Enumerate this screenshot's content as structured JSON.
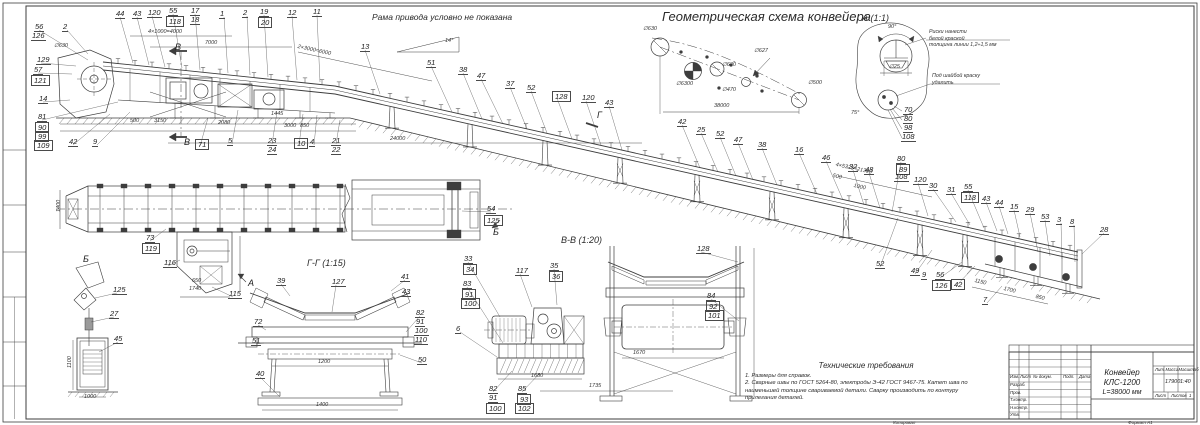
{
  "labels": {
    "frame_note": "Рама привода условно не показана",
    "scheme_title": "Геометрическая схема конвейера",
    "detail_a_title": "А (1:1)",
    "section_vv_title": "В-В (1:20)",
    "section_gg_title": "Г-Г (1:15)"
  },
  "detail_a": {
    "note1": "Риски нанести\nбелой краской\nтолщина линии 1,2÷1,5 мм",
    "note2": "Под шайбой краску\nудалить"
  },
  "tech": {
    "title": "Технические требования",
    "l1": "1. Размеры для справок.",
    "l2": "2. Сварные швы по ГОСТ 5264-80, электроды Э-42 ГОСТ 9467-75. Катет шва по",
    "l3": "наименьшей толщине свариваемой детали. Сварку производить по контуру",
    "l4": "прилегания деталей."
  },
  "title_block": {
    "name1": "Конвейер КЛС-1200",
    "name2": "L=38000 мм",
    "mass": "17900",
    "scale": "1:40",
    "h_lit": "Лит.",
    "h_mass": "Масса",
    "h_scale": "Масштаб",
    "h_sheet": "Лист",
    "h_sheets": "Листов",
    "sheets_val": "1",
    "c1": "Изм.",
    "c2": "Лист",
    "c3": "№ докум.",
    "c4": "Подп.",
    "c5": "Дата",
    "r1": "Разраб.",
    "r2": "Пров.",
    "r3": "Т.контр.",
    "r4": "Н.контр.",
    "r5": "Утв.",
    "footer_copy": "Копировал",
    "footer_format": "Формат А1"
  },
  "scheme_labels": [
    {
      "t": "∅630",
      "x": 643,
      "y": 27
    },
    {
      "t": "∅6300",
      "x": 676,
      "y": 82
    },
    {
      "t": "∅630",
      "x": 722,
      "y": 63
    },
    {
      "t": "∅627",
      "x": 754,
      "y": 49
    },
    {
      "t": "∅470",
      "x": 722,
      "y": 88
    },
    {
      "t": "∅500",
      "x": 808,
      "y": 81
    },
    {
      "t": "38000",
      "x": 714,
      "y": 104
    }
  ],
  "dims": [
    {
      "t": "500",
      "x": 130,
      "y": 119
    },
    {
      "t": "3150",
      "x": 154,
      "y": 119
    },
    {
      "t": "2080",
      "x": 218,
      "y": 121
    },
    {
      "t": "1445",
      "x": 271,
      "y": 112
    },
    {
      "t": "3000",
      "x": 284,
      "y": 124
    },
    {
      "t": "850",
      "x": 300,
      "y": 124
    },
    {
      "t": "4×1000=4000",
      "x": 148,
      "y": 30
    },
    {
      "t": "7000",
      "x": 205,
      "y": 41
    },
    {
      "t": "2×3000=6000",
      "x": 298,
      "y": 45,
      "r": 12
    },
    {
      "t": "24000",
      "x": 390,
      "y": 137
    },
    {
      "t": "14°",
      "x": 445,
      "y": 39
    },
    {
      "t": "∅630",
      "x": 54,
      "y": 44
    },
    {
      "t": "4×5325=21300",
      "x": 836,
      "y": 163,
      "r": 12
    },
    {
      "t": "500",
      "x": 833,
      "y": 174,
      "r": 12
    },
    {
      "t": "1000",
      "x": 854,
      "y": 184,
      "r": 12
    },
    {
      "t": "1150",
      "x": 975,
      "y": 279,
      "r": 13
    },
    {
      "t": "1700",
      "x": 1004,
      "y": 287,
      "r": 13
    },
    {
      "t": "850",
      "x": 1036,
      "y": 295,
      "r": 13
    },
    {
      "t": "650",
      "x": 192,
      "y": 279
    },
    {
      "t": "1740",
      "x": 189,
      "y": 287
    },
    {
      "t": "1400",
      "x": 57,
      "y": 212,
      "r": -90
    },
    {
      "t": "1100",
      "x": 68,
      "y": 368,
      "r": -90
    },
    {
      "t": "1000",
      "x": 84,
      "y": 395
    },
    {
      "t": "1200",
      "x": 318,
      "y": 360
    },
    {
      "t": "1400",
      "x": 316,
      "y": 403
    },
    {
      "t": "1680",
      "x": 531,
      "y": 374
    },
    {
      "t": "1735",
      "x": 589,
      "y": 384
    },
    {
      "t": "1670",
      "x": 633,
      "y": 351
    },
    {
      "t": "∅25",
      "x": 889,
      "y": 65
    },
    {
      "t": "90°",
      "x": 888,
      "y": 25
    },
    {
      "t": "75°",
      "x": 851,
      "y": 111
    }
  ],
  "callouts": [
    {
      "t": "56",
      "x": 34,
      "y": 23,
      "tx": 88,
      "ty": 60
    },
    {
      "t": "126",
      "x": 31,
      "y": 32
    },
    {
      "t": "129",
      "x": 36,
      "y": 56,
      "tx": 76,
      "ty": 66
    },
    {
      "t": "57",
      "x": 33,
      "y": 66,
      "tx": 72,
      "ty": 74
    },
    {
      "t": "121",
      "x": 31,
      "y": 75,
      "b": 1
    },
    {
      "t": "14",
      "x": 38,
      "y": 95,
      "tx": 70,
      "ty": 100
    },
    {
      "t": "81",
      "x": 37,
      "y": 113,
      "tx": 118,
      "ty": 102
    },
    {
      "t": "90",
      "x": 35,
      "y": 122,
      "b": 1
    },
    {
      "t": "99",
      "x": 35,
      "y": 131,
      "b": 1
    },
    {
      "t": "109",
      "x": 34,
      "y": 140,
      "b": 1
    },
    {
      "t": "42",
      "x": 68,
      "y": 138,
      "tx": 110,
      "ty": 114
    },
    {
      "t": "9",
      "x": 92,
      "y": 138,
      "tx": 130,
      "ty": 112
    },
    {
      "t": "2",
      "x": 62,
      "y": 23,
      "tx": 88,
      "ty": 54
    },
    {
      "t": "44",
      "x": 115,
      "y": 10,
      "tx": 133,
      "ty": 63
    },
    {
      "t": "43",
      "x": 132,
      "y": 10,
      "tx": 149,
      "ty": 65
    },
    {
      "t": "120",
      "x": 147,
      "y": 9,
      "tx": 165,
      "ty": 67
    },
    {
      "t": "55",
      "x": 168,
      "y": 7,
      "tx": 182,
      "ty": 68
    },
    {
      "t": "118",
      "x": 166,
      "y": 16,
      "b": 1
    },
    {
      "t": "17",
      "x": 190,
      "y": 7,
      "tx": 200,
      "ty": 70
    },
    {
      "t": "18",
      "x": 190,
      "y": 16
    },
    {
      "t": "1",
      "x": 219,
      "y": 10,
      "tx": 228,
      "ty": 73
    },
    {
      "t": "2",
      "x": 242,
      "y": 9,
      "tx": 250,
      "ty": 75
    },
    {
      "t": "19",
      "x": 259,
      "y": 8,
      "tx": 268,
      "ty": 77
    },
    {
      "t": "20",
      "x": 258,
      "y": 17,
      "b": 1
    },
    {
      "t": "12",
      "x": 287,
      "y": 9,
      "tx": 297,
      "ty": 80
    },
    {
      "t": "11",
      "x": 312,
      "y": 8,
      "tx": 320,
      "ty": 82
    },
    {
      "t": "13",
      "x": 360,
      "y": 43,
      "tx": 380,
      "ty": 94
    },
    {
      "t": "71",
      "x": 195,
      "y": 139,
      "b": 1,
      "tx": 208,
      "ty": 118
    },
    {
      "t": "5",
      "x": 227,
      "y": 137,
      "tx": 238,
      "ty": 110
    },
    {
      "t": "23",
      "x": 267,
      "y": 137,
      "tx": 277,
      "ty": 112
    },
    {
      "t": "24",
      "x": 267,
      "y": 146
    },
    {
      "t": "10",
      "x": 294,
      "y": 138,
      "b": 1,
      "tx": 303,
      "ty": 114
    },
    {
      "t": "4",
      "x": 309,
      "y": 138,
      "tx": 317,
      "ty": 115
    },
    {
      "t": "21",
      "x": 331,
      "y": 137,
      "tx": 340,
      "ty": 120
    },
    {
      "t": "22",
      "x": 331,
      "y": 146
    },
    {
      "t": "51",
      "x": 426,
      "y": 59,
      "tx": 452,
      "ty": 112
    },
    {
      "t": "38",
      "x": 458,
      "y": 66,
      "tx": 482,
      "ty": 119
    },
    {
      "t": "47",
      "x": 476,
      "y": 72,
      "tx": 503,
      "ty": 124
    },
    {
      "t": "37",
      "x": 505,
      "y": 80,
      "tx": 527,
      "ty": 129
    },
    {
      "t": "52",
      "x": 526,
      "y": 84,
      "tx": 547,
      "ty": 133
    },
    {
      "t": "128",
      "x": 552,
      "y": 91,
      "b": 1,
      "tx": 572,
      "ty": 139
    },
    {
      "t": "120",
      "x": 581,
      "y": 94,
      "tx": 601,
      "ty": 145
    },
    {
      "t": "43",
      "x": 604,
      "y": 99,
      "tx": 622,
      "ty": 150
    },
    {
      "t": "42",
      "x": 677,
      "y": 118,
      "tx": 700,
      "ty": 168
    },
    {
      "t": "25",
      "x": 696,
      "y": 126,
      "tx": 718,
      "ty": 172
    },
    {
      "t": "52",
      "x": 715,
      "y": 130,
      "tx": 736,
      "ty": 176
    },
    {
      "t": "47",
      "x": 733,
      "y": 136,
      "tx": 753,
      "ty": 180
    },
    {
      "t": "38",
      "x": 757,
      "y": 141,
      "tx": 777,
      "ty": 185
    },
    {
      "t": "16",
      "x": 794,
      "y": 146,
      "tx": 817,
      "ty": 194
    },
    {
      "t": "46",
      "x": 821,
      "y": 154,
      "tx": 843,
      "ty": 200
    },
    {
      "t": "32",
      "x": 848,
      "y": 163,
      "tx": 864,
      "ty": 205
    },
    {
      "t": "48",
      "x": 864,
      "y": 166,
      "tx": 880,
      "ty": 208
    },
    {
      "t": "80",
      "x": 896,
      "y": 155,
      "tx": 892,
      "ty": 212
    },
    {
      "t": "89",
      "x": 896,
      "y": 164,
      "b": 1
    },
    {
      "t": "108",
      "x": 894,
      "y": 173
    },
    {
      "t": "120",
      "x": 913,
      "y": 176,
      "tx": 928,
      "ty": 216
    },
    {
      "t": "70",
      "x": 903,
      "y": 106
    },
    {
      "t": "80",
      "x": 903,
      "y": 115
    },
    {
      "t": "98",
      "x": 903,
      "y": 124
    },
    {
      "t": "108",
      "x": 901,
      "y": 133
    },
    {
      "t": "30",
      "x": 928,
      "y": 182,
      "tx": 956,
      "ty": 222
    },
    {
      "t": "31",
      "x": 946,
      "y": 186,
      "tx": 970,
      "ty": 225
    },
    {
      "t": "55",
      "x": 963,
      "y": 183,
      "tx": 984,
      "ty": 228
    },
    {
      "t": "118",
      "x": 961,
      "y": 192,
      "b": 1
    },
    {
      "t": "43",
      "x": 981,
      "y": 195,
      "tx": 997,
      "ty": 231
    },
    {
      "t": "44",
      "x": 994,
      "y": 199,
      "tx": 1008,
      "ty": 234
    },
    {
      "t": "15",
      "x": 1009,
      "y": 203,
      "tx": 1020,
      "ty": 237
    },
    {
      "t": "29",
      "x": 1025,
      "y": 206,
      "tx": 1038,
      "ty": 252
    },
    {
      "t": "53",
      "x": 1040,
      "y": 213,
      "tx": 1050,
      "ty": 256
    },
    {
      "t": "3",
      "x": 1056,
      "y": 216,
      "tx": 1062,
      "ty": 259
    },
    {
      "t": "8",
      "x": 1069,
      "y": 218,
      "tx": 1075,
      "ty": 262
    },
    {
      "t": "28",
      "x": 1099,
      "y": 226,
      "tx": 1082,
      "ty": 254
    },
    {
      "t": "52",
      "x": 875,
      "y": 260,
      "tx": 898,
      "ty": 218
    },
    {
      "t": "49",
      "x": 910,
      "y": 267,
      "tx": 932,
      "ty": 250
    },
    {
      "t": "9",
      "x": 921,
      "y": 271
    },
    {
      "t": "56",
      "x": 935,
      "y": 271,
      "tx": 962,
      "ty": 262
    },
    {
      "t": "126",
      "x": 932,
      "y": 280,
      "b": 1
    },
    {
      "t": "42",
      "x": 951,
      "y": 279,
      "b": 1,
      "tx": 975,
      "ty": 266
    },
    {
      "t": "7",
      "x": 982,
      "y": 296,
      "tx": 1002,
      "ty": 286
    },
    {
      "t": "73",
      "x": 145,
      "y": 234,
      "tx": 166,
      "ty": 229
    },
    {
      "t": "119",
      "x": 142,
      "y": 243,
      "b": 1
    },
    {
      "t": "116",
      "x": 163,
      "y": 259,
      "tx": 180,
      "ty": 260
    },
    {
      "t": "115",
      "x": 228,
      "y": 290,
      "tx": 212,
      "ty": 287
    },
    {
      "t": "54",
      "x": 486,
      "y": 205,
      "tx": 462,
      "ty": 211
    },
    {
      "t": "125",
      "x": 484,
      "y": 215,
      "b": 1
    },
    {
      "t": "В",
      "x": 174,
      "y": 44,
      "p": 1
    },
    {
      "t": "В",
      "x": 183,
      "y": 139,
      "p": 1
    },
    {
      "t": "Г",
      "x": 596,
      "y": 112,
      "p": 1
    },
    {
      "t": "Б",
      "x": 492,
      "y": 229,
      "p": 1
    },
    {
      "t": "А",
      "x": 247,
      "y": 280,
      "p": 1
    },
    {
      "t": "Б",
      "x": 82,
      "y": 256,
      "p": 1
    },
    {
      "t": "125",
      "x": 112,
      "y": 286,
      "tx": 95,
      "ty": 298
    },
    {
      "t": "27",
      "x": 109,
      "y": 310,
      "tx": 91,
      "ty": 322
    },
    {
      "t": "45",
      "x": 113,
      "y": 335,
      "tx": 99,
      "ty": 352
    },
    {
      "t": "39",
      "x": 276,
      "y": 277,
      "tx": 290,
      "ty": 296
    },
    {
      "t": "127",
      "x": 331,
      "y": 278,
      "tx": 332,
      "ty": 312
    },
    {
      "t": "41",
      "x": 400,
      "y": 273,
      "tx": 391,
      "ty": 291
    },
    {
      "t": "43",
      "x": 401,
      "y": 288,
      "tx": 397,
      "ty": 298
    },
    {
      "t": "72",
      "x": 253,
      "y": 318,
      "tx": 266,
      "ty": 330
    },
    {
      "t": "51",
      "x": 251,
      "y": 337,
      "tx": 264,
      "ty": 343
    },
    {
      "t": "40",
      "x": 255,
      "y": 370,
      "tx": 280,
      "ty": 397
    },
    {
      "t": "82",
      "x": 415,
      "y": 309,
      "tx": 406,
      "ty": 332
    },
    {
      "t": "91",
      "x": 415,
      "y": 318
    },
    {
      "t": "100",
      "x": 414,
      "y": 327
    },
    {
      "t": "110",
      "x": 414,
      "y": 336
    },
    {
      "t": "50",
      "x": 417,
      "y": 356,
      "tx": 400,
      "ty": 355
    },
    {
      "t": "33",
      "x": 463,
      "y": 255,
      "tx": 500,
      "ty": 317
    },
    {
      "t": "34",
      "x": 463,
      "y": 264,
      "b": 1
    },
    {
      "t": "117",
      "x": 515,
      "y": 267,
      "tx": 532,
      "ty": 307
    },
    {
      "t": "35",
      "x": 549,
      "y": 262,
      "tx": 557,
      "ty": 305
    },
    {
      "t": "36",
      "x": 549,
      "y": 271,
      "b": 1
    },
    {
      "t": "128",
      "x": 696,
      "y": 245,
      "tx": 738,
      "ty": 262
    },
    {
      "t": "83",
      "x": 462,
      "y": 280,
      "tx": 503,
      "ty": 343
    },
    {
      "t": "91",
      "x": 462,
      "y": 289,
      "b": 1
    },
    {
      "t": "100",
      "x": 461,
      "y": 298,
      "b": 1
    },
    {
      "t": "6",
      "x": 455,
      "y": 325,
      "tx": 497,
      "ty": 357
    },
    {
      "t": "84",
      "x": 706,
      "y": 292,
      "tx": 739,
      "ty": 321
    },
    {
      "t": "92",
      "x": 706,
      "y": 301,
      "b": 1
    },
    {
      "t": "101",
      "x": 705,
      "y": 310,
      "b": 1
    },
    {
      "t": "82",
      "x": 488,
      "y": 385,
      "tx": 512,
      "ty": 371
    },
    {
      "t": "91",
      "x": 488,
      "y": 394
    },
    {
      "t": "100",
      "x": 486,
      "y": 403,
      "b": 1
    },
    {
      "t": "85",
      "x": 517,
      "y": 385,
      "tx": 540,
      "ty": 373
    },
    {
      "t": "93",
      "x": 517,
      "y": 394,
      "b": 1
    },
    {
      "t": "102",
      "x": 515,
      "y": 403,
      "b": 1
    }
  ]
}
